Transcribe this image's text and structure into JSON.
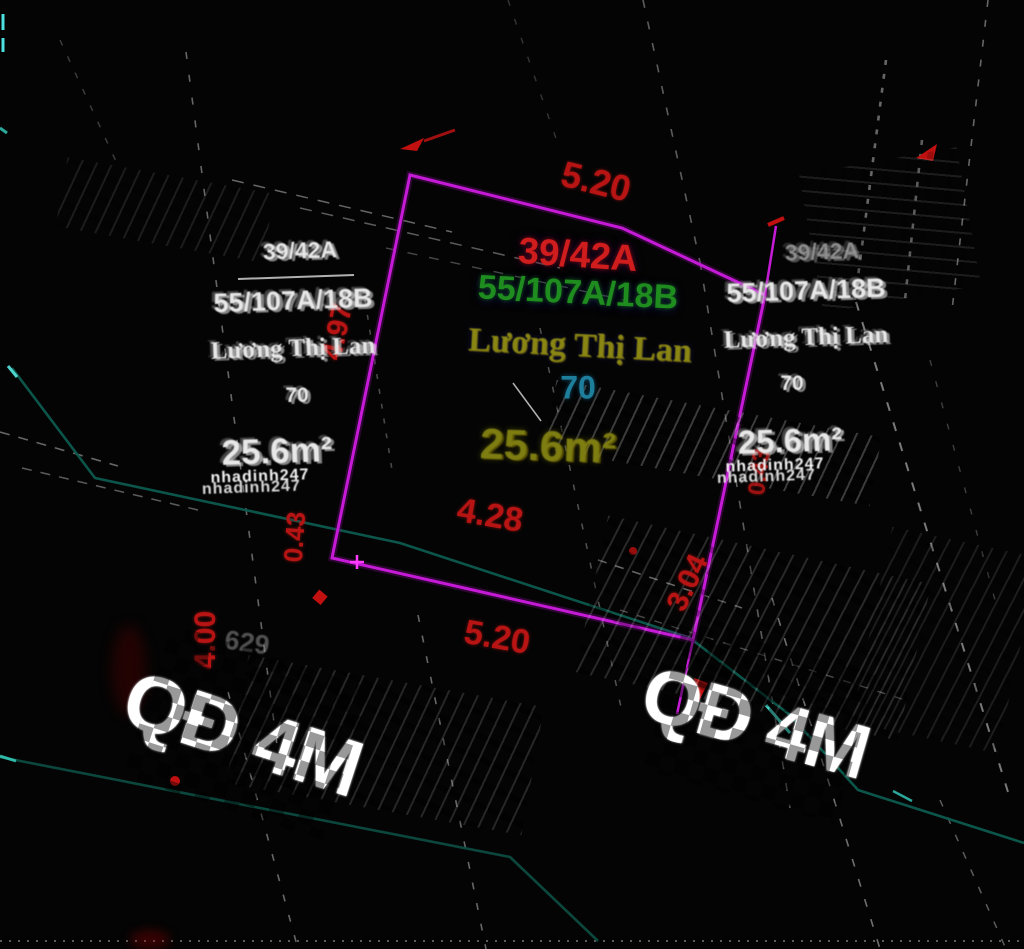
{
  "labels": {
    "plot_code": "39/42A",
    "address": "55/107A/18B",
    "owner": "Lương Thị Lan",
    "lot_number": "70",
    "area": "25.6m²"
  },
  "dims": {
    "top": "5.20",
    "left": "4.97",
    "bottom_inner": "4.28",
    "bottom_outer": "5.20",
    "corner": "0.43",
    "stub": "3.04",
    "road_edge": "4.00"
  },
  "ghost": {
    "watermark": "nhadinh247",
    "faint_number": "629"
  },
  "road": {
    "label": "QĐ 4M"
  },
  "colors": {
    "background": "#040404",
    "boundary_magenta": "#c51ad6",
    "dimension_red": "#b81414",
    "plot_code_red": "#cf1d1d",
    "address_green": "#1f8c1f",
    "owner_yellow": "#8a8614",
    "lot_cyan": "#1d7f9c",
    "area_olive": "#7d7d12",
    "ghost_white": "#e8e8e8",
    "survey_teal": "#0d5a4e",
    "dash_gray": "#c8c8c8"
  }
}
